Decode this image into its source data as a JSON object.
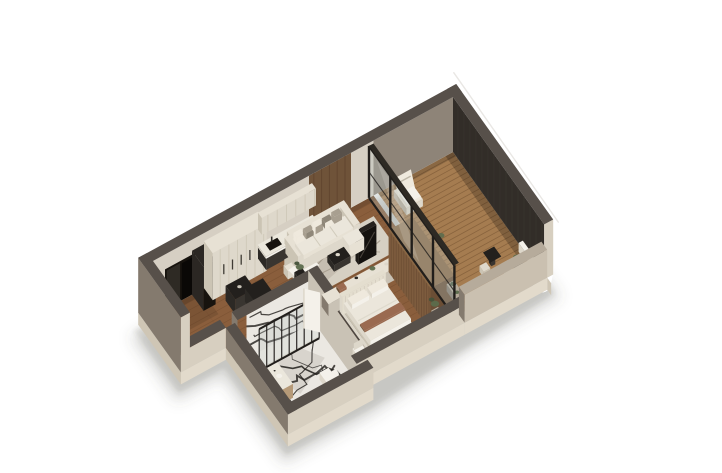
{
  "scene": {
    "type": "3d-isometric-floorplan-render",
    "view": "axonometric cutaway of a one-bedroom apartment, white background",
    "background": "#ffffff",
    "rooms": [
      {
        "name": "entry-hall"
      },
      {
        "name": "kitchen"
      },
      {
        "name": "dining-area"
      },
      {
        "name": "living-area"
      },
      {
        "name": "hallway"
      },
      {
        "name": "bathroom"
      },
      {
        "name": "bedroom"
      },
      {
        "name": "balcony"
      }
    ],
    "furniture": [
      "kitchen-tall-cabinets",
      "kitchen-upper-cabinets",
      "kitchen-counter",
      "kitchen-island",
      "dining-table",
      "dining-chairs",
      "sofa",
      "throw-pillows",
      "area-rug",
      "coffee-table",
      "side-table-plant",
      "tv-panel",
      "media-console",
      "entry-closet",
      "bed",
      "headboard",
      "bed-bench",
      "bedroom-armchair",
      "wardrobe",
      "shower-glass",
      "shower-tray",
      "marble-wall",
      "toilet",
      "vanity",
      "bathroom-door",
      "balcony-lounge-chair",
      "balcony-bistro-set",
      "balcony-planters",
      "ac-units",
      "potted-plants"
    ],
    "palette": {
      "bg": "#ffffff",
      "shadow": "#55504a",
      "cap": "#57504a",
      "capLight": "#b6ab9b",
      "extWest": "#847a6e",
      "extSouth": "#d7cfc0",
      "extSouthDim": "#cac0b0",
      "plinthWest": "#cfc6b5",
      "plinthSouth": "#e2dacb",
      "plaster": "#d6cfc3",
      "plasterShade": "#c9c2b5",
      "accentWood": "#6f5339",
      "accentLine": "#5a3f2b",
      "balcWallN": "#8e8478",
      "darkWall": "#322d28",
      "darkLine": "#3b352e",
      "doorDark": "#17130e",
      "doorLeaf": "#2e2a24",
      "closetDark": "#2b2723",
      "floorWood": "#8a5e3c",
      "floorSeam": "#5f3f26",
      "deck": "#a57c50",
      "deckSeam": "#6d4c2c",
      "marble": "#ebe8e2",
      "marbleVein": "#201d1a",
      "marbleGray": "#b5b0a7",
      "cream": "#ded8cb",
      "creamSide": "#cbc4b4",
      "creamTop": "#e7e1d4",
      "counterTop": "#ebe7dc",
      "darkCab": "#393530",
      "darkCabSide": "#2c2925",
      "darkCabTop": "#23201d",
      "white": "#f4f1ea",
      "whiteShade": "#ddd7ca",
      "pillowA": "#efe9dd",
      "pillowB": "#a89f90",
      "pillowC": "#8f8779",
      "rug": "#d6d0c3",
      "rugLine": "#8f8473",
      "woodFurn": "#7d5c3e",
      "woodFurnSide": "#6b4e35",
      "woodFurnLine": "#684a31",
      "woodFurnTop": "#8a6845",
      "glass": "#b9c4c0",
      "frame": "#211e1b",
      "green": "#5c6c4c",
      "greenDark": "#44523a",
      "rust": "#9a6a50",
      "tvWest": "#1d1a17",
      "tvSouth": "#15120f",
      "tvTop": "#26221e",
      "duvet": "#ebe6db",
      "headboard": "#e4decf",
      "headboardLine": "#d0c9bb",
      "bench": "#b9b0a0",
      "vanityWood": "#b69a78",
      "vanityWoodSide": "#9b8162",
      "black": "#000000",
      "facade": "#ffffff",
      "facadeEdge": "#e9e7e4"
    }
  }
}
